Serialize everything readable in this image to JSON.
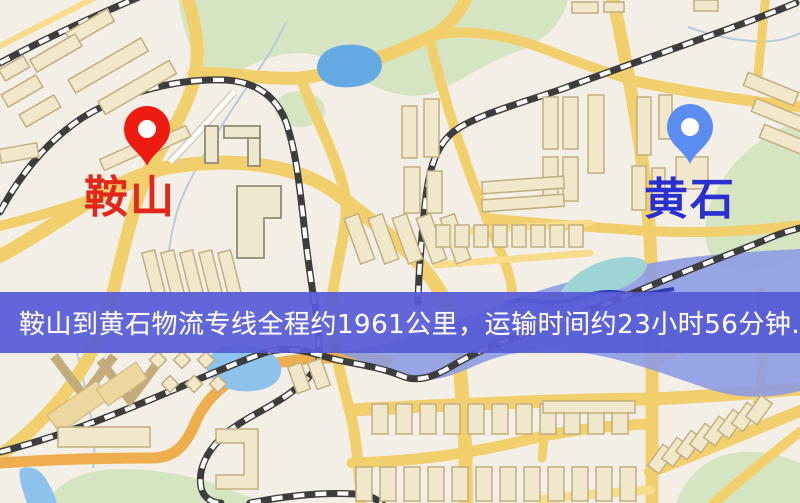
{
  "banner": {
    "text": "鞍山到黄石物流专线全程约1961公里，运输时间约23小时56分钟.",
    "background_color": "#575bd7",
    "text_color": "#ffffff",
    "distance_shown": "1961公里",
    "duration_shown": "23小时56分钟"
  },
  "markers": {
    "origin": {
      "label": "鞍山",
      "label_color": "#e3271b",
      "pin_color": "#ee1c10",
      "icon": "map-pin"
    },
    "destination": {
      "label": "黄石",
      "label_color": "#2a2fd0",
      "pin_color": "#5b8cf0",
      "icon": "map-pin"
    }
  },
  "map_palette": {
    "background": "#f4efe6",
    "road_yellow": "#f2cf6d",
    "road_orange": "#efae4e",
    "park_green": "#d5e5c1",
    "water_blue": "#8cc2ec",
    "water_band_blue": "#8a9be4",
    "building_fill": "#f1e7cb",
    "building_stroke": "#c2ae7f",
    "railway_dark": "#3d3d3d"
  }
}
